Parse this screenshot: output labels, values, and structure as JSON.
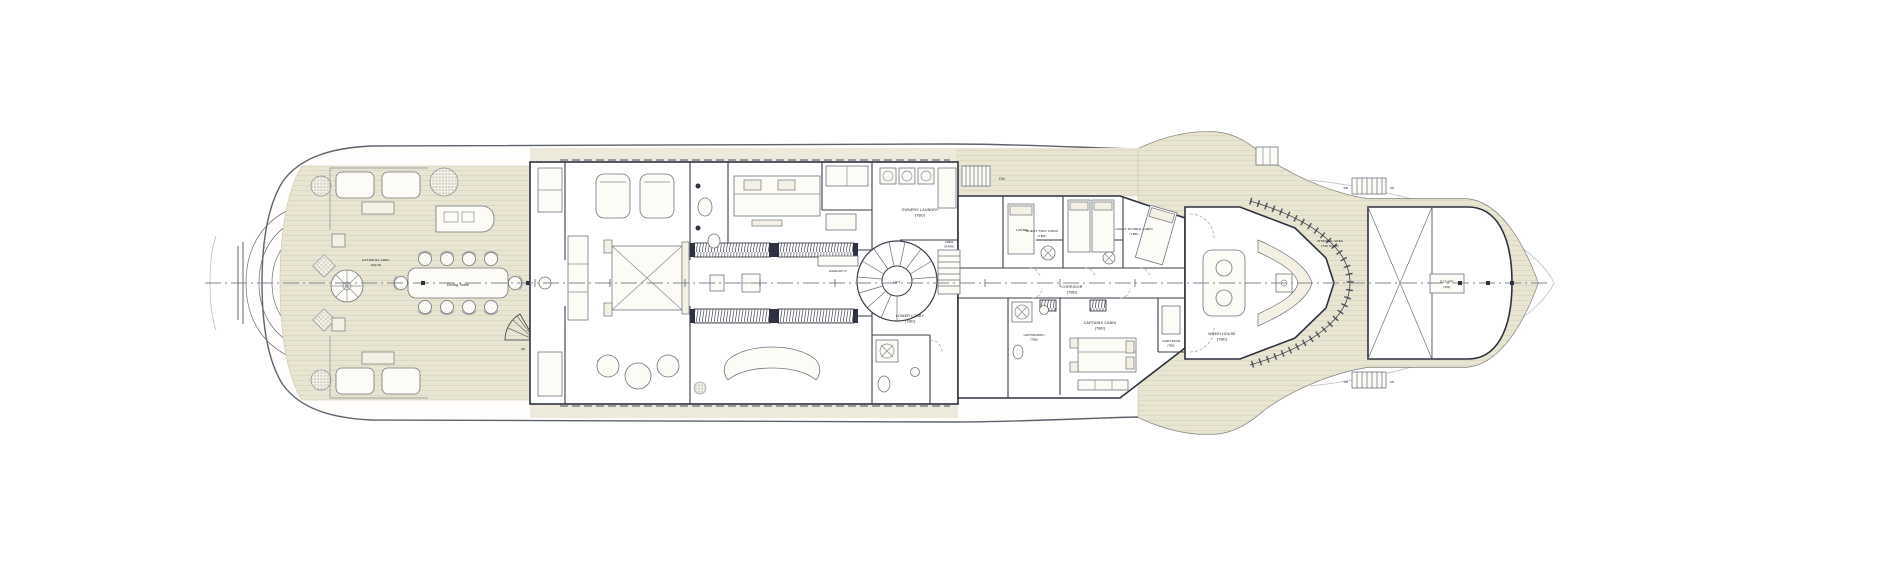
{
  "document": {
    "title": "Yacht General Arrangement — Deck Plan"
  },
  "colors": {
    "paper": "#ffffff",
    "deck": "#e8e5d2",
    "deck_plank_line": "#d6d2ba",
    "walkway": "#edeadc",
    "wall": "#2e3240",
    "line": "#565b66",
    "label": "#17171c"
  },
  "labels": {
    "owners_laundry_1": "OWNERS LAUNDRY",
    "owners_laundry_2": "(TBD)",
    "lift": "LIFT",
    "crew_stairs_1": "CREW",
    "crew_stairs_2": "STAIRS",
    "lower_lobby_1": "LOWER LOBBY",
    "lower_lobby_2": "(TBD)",
    "corridor_1": "CORRIDOR",
    "corridor_2": "(TBD)",
    "guest_twin_1": "GUEST TWIN CABIN",
    "guest_twin_2": "(TBD)",
    "guest_double_1": "GUEST DOUBLE CABIN",
    "guest_double_2": "(TBD)",
    "captains_cabin_1": "CAPTAINS CABIN",
    "captains_cabin_2": "(TBD)",
    "captains_bath_1": "CAPTAINS BATH",
    "captains_bath_2": "(TBD)",
    "chart_room_1": "CHART ROOM",
    "chart_room_2": "(TBD)",
    "wheelhouse_1": "WHEELHOUSE",
    "wheelhouse_2": "(TBD)",
    "internal_area_1": "INTERNAL AREA",
    "internal_area_2": "(742 SQ M)",
    "external_area_1": "EXTERNAL AREA",
    "external_area_2": "(SQ M)",
    "dining_table": "Dining Table",
    "high_low_tv": "HIGH/LOW TV",
    "escape_1": "ESCAPE",
    "escape_2": "(DN)",
    "bed_tag": "2.0M BED"
  },
  "stairs": {
    "dn": "DN",
    "up": "UP"
  }
}
